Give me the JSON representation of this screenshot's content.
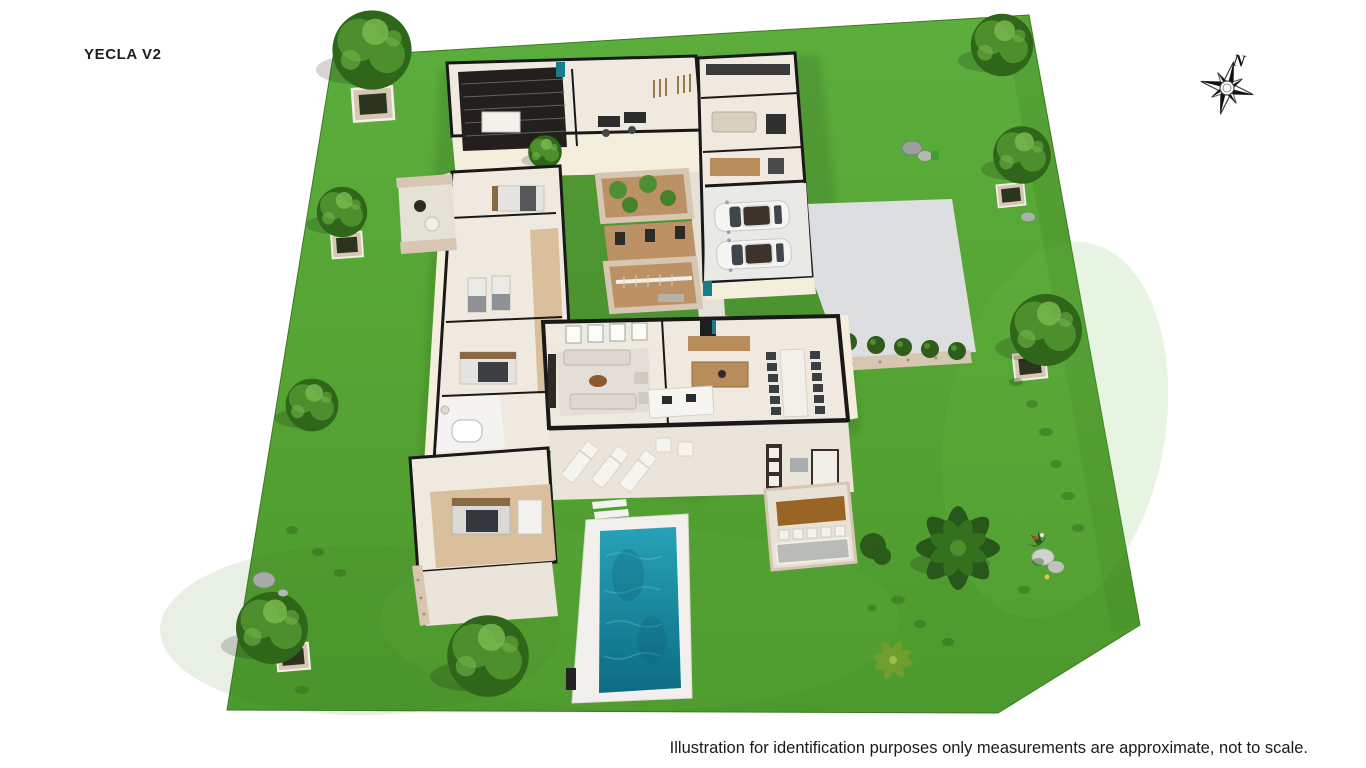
{
  "page": {
    "title": "YECLA V2"
  },
  "compass": {
    "label": "N",
    "icon": "compass-rose-icon"
  },
  "footer": {
    "disclaimer": "Illustration for identification purposes only measurements are approximate, not to scale."
  },
  "palette": {
    "grass": "#57a637",
    "grass-dark": "#3e7f24",
    "grass-light": "#72bd4a",
    "concrete": "#dcdee0",
    "garage-floor": "#e9e9e6",
    "floor": "#efe9e0",
    "terrace": "#eae4da",
    "plaza": "#e6e1d6",
    "pool-deck": "#f2f0ec",
    "pool-light": "#27a2b8",
    "pool-dark": "#0c6c82",
    "wall-dark": "#191919",
    "wall-cream": "#f4eedd",
    "wood-floor": "#d9bf9b",
    "wood": "#b88d5b",
    "wood-dark": "#9a6524",
    "dirt": "#bc9165",
    "stone": "#d6c6b2",
    "tree-dark": "#2f6619",
    "tree-mid": "#4c8f2c",
    "tree-light": "#79b94e",
    "palm-dark": "#27571a",
    "car-body": "#f5f5f3",
    "car-glass": "#41464c",
    "teal-accent": "#177d88",
    "sofa-light": "#dcd8cf",
    "sofa-dark": "#3a3f44",
    "ink": "#1a1a1a"
  }
}
